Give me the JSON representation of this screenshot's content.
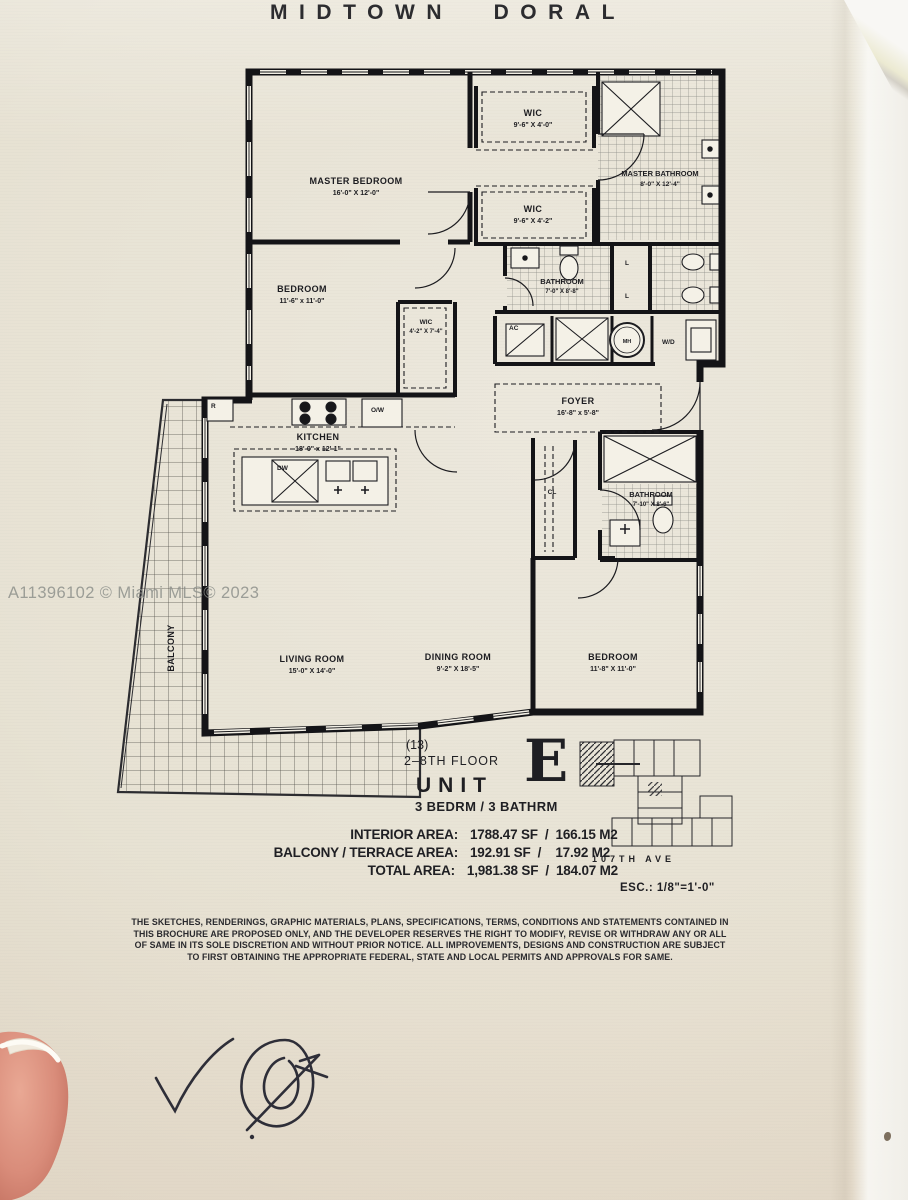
{
  "watermark": "A11396102 © Miami MLS© 2023",
  "title": "MIDTOWN DORAL",
  "plan": {
    "rooms": {
      "master_bedroom": {
        "name": "MASTER BEDROOM",
        "dim": "16'-0\" X 12'-0\""
      },
      "wic1": {
        "name": "WIC",
        "dim": "9'-6\" X 4'-0\""
      },
      "master_bathroom": {
        "name": "MASTER BATHROOM",
        "dim": "8'-0\" X 12'-4\""
      },
      "wic2": {
        "name": "WIC",
        "dim": "9'-6\" X 4'-2\""
      },
      "bedroom2": {
        "name": "BEDROOM",
        "dim": "11'-6\" x 11'-0\""
      },
      "wic3": {
        "name": "WIC",
        "dim": "4'-2\" X 7'-4\""
      },
      "bathroom2": {
        "name": "BATHROOM",
        "dim": "7'-0\" X 8'-8\""
      },
      "foyer": {
        "name": "FOYER",
        "dim": "16'-8\" x 5'-8\""
      },
      "kitchen": {
        "name": "KITCHEN",
        "dim": "18'-0\" x 12'-1\""
      },
      "closet": {
        "name": "CL"
      },
      "bathroom3": {
        "name": "BATHROOM",
        "dim": "7'-10\" X 8'-6\""
      },
      "living_room": {
        "name": "LIVING ROOM",
        "dim": "15'-0\" X 14'-0\""
      },
      "dining_room": {
        "name": "DINING ROOM",
        "dim": "9'-2\" X 18'-5\""
      },
      "bedroom3": {
        "name": "BEDROOM",
        "dim": "11'-8\" X 11'-0\""
      },
      "balcony": {
        "name": "BALCONY"
      }
    },
    "fixtures": {
      "fridge": "R",
      "oven": "O/W",
      "dishwasher": "DW",
      "linen1": "L",
      "linen2": "L",
      "ac": "AC",
      "mh": "MH",
      "washer_dryer": "W/D"
    }
  },
  "info": {
    "floors_note": "(13)",
    "floor_range": "2–8TH FLOOR",
    "unit_label": "UNIT",
    "unit_letter": "E",
    "config": "3 BEDRM  /  3 BATHRM",
    "areas": [
      {
        "label": "INTERIOR AREA:",
        "value": "1788.47 SF  /  166.15 M2"
      },
      {
        "label": "BALCONY / TERRACE AREA:",
        "value": "192.91 SF  /    17.92 M2"
      },
      {
        "label": "TOTAL AREA:",
        "value": "1,981.38 SF  /  184.07 M2"
      }
    ],
    "street": "107TH  AVE",
    "scale": "ESC.:  1/8\"=1'-0\""
  },
  "disclaimer": {
    "lines": [
      "THE SKETCHES, RENDERINGS, GRAPHIC MATERIALS, PLANS, SPECIFICATIONS, TERMS,  CONDITIONS AND STATEMENTS CONTAINED IN",
      "THIS BROCHURE ARE PROPOSED ONLY, AND THE DEVELOPER RESERVES THE RIGHT TO MODIFY, REVISE OR WITHDRAW ANY OR ALL",
      "OF SAME IN ITS SOLE DISCRETION AND WITHOUT PRIOR NOTICE. ALL IMPROVEMENTS, DESIGNS AND CONSTRUCTION ARE SUBJECT",
      "TO FIRST OBTAINING THE  APPROPRIATE  FEDERAL,  STATE AND LOCAL PERMITS AND APPROVALS FOR SAME."
    ]
  }
}
